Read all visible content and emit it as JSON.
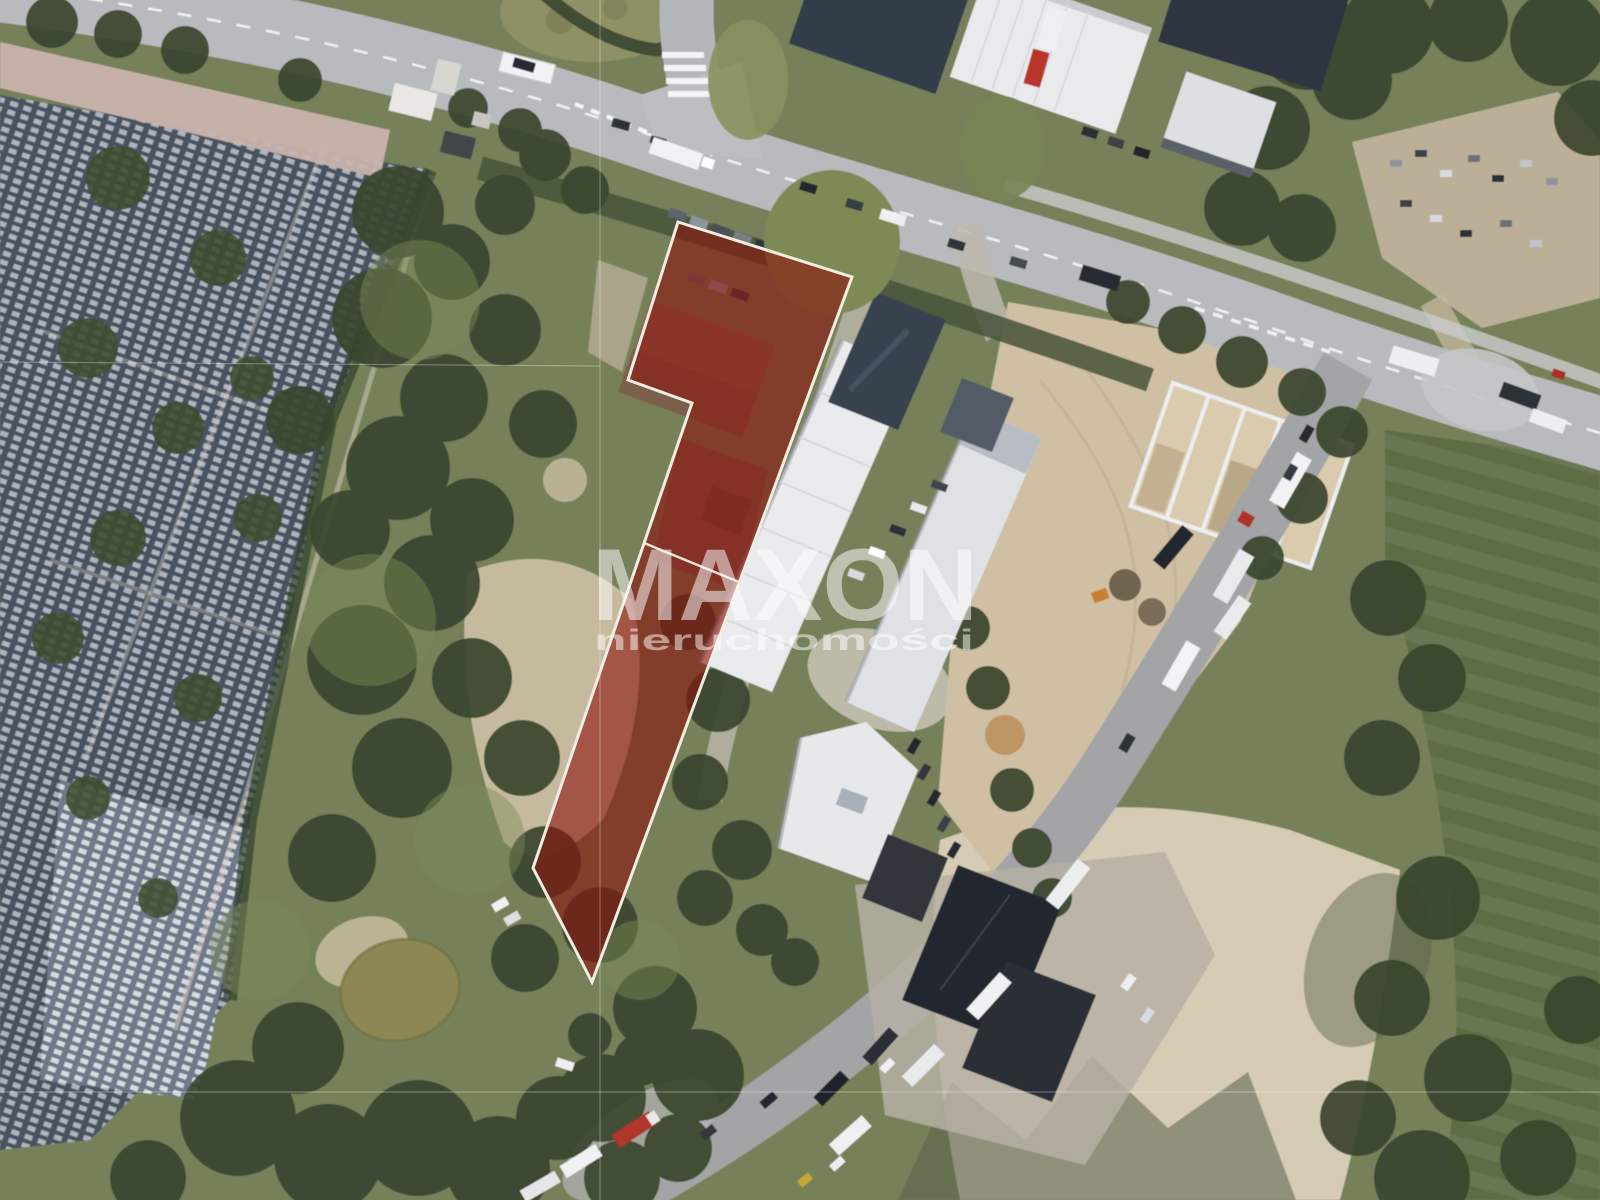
{
  "watermark": {
    "brand": "MAXON",
    "subtitle": "nieruchomości",
    "color": "#ffffff",
    "brand_opacity": "0.52",
    "subtitle_opacity": "0.5"
  },
  "parcel_overlay": {
    "fill": "#8c130b",
    "fill_opacity": "0.6",
    "stroke": "#f3ece1",
    "stroke_width": "3",
    "outline_points": "678,222 852,277 592,982 533,868 692,403 628,380",
    "division_line_path": "M644,543 L739,582"
  },
  "guide_lines": {
    "color": "#ffffff",
    "vertical_x": "600",
    "horizontal_y_top": "362",
    "horizontal_y_bottom": "1092"
  },
  "palette": {
    "vegetation": "#76815a",
    "tree_dark": "#3a462d",
    "cemetery_dark": "#49525f",
    "cemetery_light": "#707989",
    "grave_marker": "#bfc6cf",
    "road_light": "#b8bbbe",
    "road_dark": "#a2a4a6",
    "path_pink": "#c9b3ad",
    "sand_light": "#d6cbb4",
    "sand_yard": "#cfc0a4",
    "field_green": "#5e6d47",
    "pond": "#8d8852",
    "roof_white": "#e9ebed",
    "roof_dark": "#39424f",
    "roof_black": "#23272d",
    "marking_white": "#ffffff"
  }
}
